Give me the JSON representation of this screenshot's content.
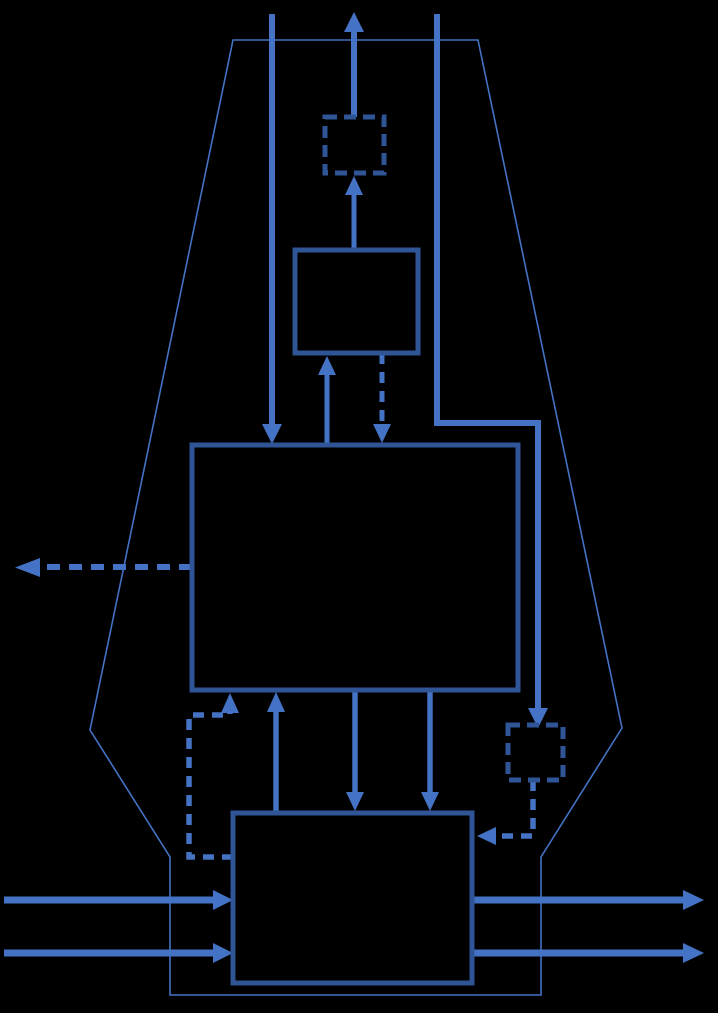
{
  "canvas": {
    "width": 718,
    "height": 1013,
    "background": "#000000"
  },
  "colors": {
    "box_stroke": "#2F5597",
    "arrow": "#4472C4",
    "outline": "#4472C4",
    "background": "#000000"
  },
  "diagram": {
    "type": "flow-diagram",
    "text_labels": [],
    "nodes": [
      {
        "id": "funnel-outline",
        "shape": "polygon",
        "border": "thin-solid",
        "description": "tall funnel/vase shaped outline enclosing the flow"
      },
      {
        "id": "top-dashed-box",
        "shape": "rect",
        "border": "dashed",
        "description": "small dashed square near top center"
      },
      {
        "id": "upper-box",
        "shape": "rect",
        "border": "solid",
        "description": "small solid rectangle above main box"
      },
      {
        "id": "main-box",
        "shape": "rect",
        "border": "solid",
        "description": "large central rectangle"
      },
      {
        "id": "bottom-box",
        "shape": "rect",
        "border": "solid",
        "description": "bottom rectangle with horizontal through-flows"
      },
      {
        "id": "right-dashed-box",
        "shape": "rect",
        "border": "dashed",
        "description": "small dashed square on right side"
      }
    ],
    "edges": [
      {
        "id": "feed-top-to-main",
        "style": "solid",
        "direction": "down",
        "description": "long vertical arrow from top edge into main-box top"
      },
      {
        "id": "exit-top",
        "style": "solid",
        "direction": "up",
        "description": "arrow from top-dashed-box exiting through diagram top"
      },
      {
        "id": "top-right-path",
        "style": "solid",
        "direction": "down",
        "description": "vertical line from top bending right then down into right-dashed-box"
      },
      {
        "id": "main-to-upper",
        "style": "solid",
        "direction": "up",
        "description": "arrow from main-box top into upper-box bottom"
      },
      {
        "id": "upper-to-main",
        "style": "dashed",
        "direction": "down",
        "description": "dashed arrow from upper-box bottom into main-box top"
      },
      {
        "id": "upper-to-top-dashed-box",
        "style": "solid",
        "direction": "up",
        "description": "arrow from upper-box top into top-dashed-box bottom"
      },
      {
        "id": "main-left-exit",
        "style": "dashed",
        "direction": "left",
        "description": "dashed arrow leaving main-box left edge toward diagram left edge"
      },
      {
        "id": "bottom-to-main",
        "style": "solid",
        "direction": "up",
        "description": "arrow from bottom-box top into main-box bottom"
      },
      {
        "id": "bottom-loop-to-main",
        "style": "dashed",
        "direction": "up",
        "description": "dashed elbow loop from bottom-box left edge up into main-box bottom"
      },
      {
        "id": "main-to-bottom-1",
        "style": "solid",
        "direction": "down",
        "description": "arrow from main-box bottom into bottom-box top (left of pair)"
      },
      {
        "id": "main-to-bottom-2",
        "style": "solid",
        "direction": "down",
        "description": "arrow from main-box bottom into bottom-box top (right of pair)"
      },
      {
        "id": "right-dashed-box-to-bottom",
        "style": "dashed",
        "direction": "left",
        "description": "dashed elbow from right-dashed-box bottom into bottom-box right edge"
      },
      {
        "id": "inflow-1",
        "style": "solid",
        "direction": "right",
        "description": "horizontal arrow entering bottom-box left edge (upper)"
      },
      {
        "id": "inflow-2",
        "style": "solid",
        "direction": "right",
        "description": "horizontal arrow entering bottom-box left edge (lower)"
      },
      {
        "id": "outflow-1",
        "style": "solid",
        "direction": "right",
        "description": "horizontal arrow leaving bottom-box right edge (upper)"
      },
      {
        "id": "outflow-2",
        "style": "solid",
        "direction": "right",
        "description": "horizontal arrow leaving bottom-box right edge (lower)"
      }
    ]
  }
}
